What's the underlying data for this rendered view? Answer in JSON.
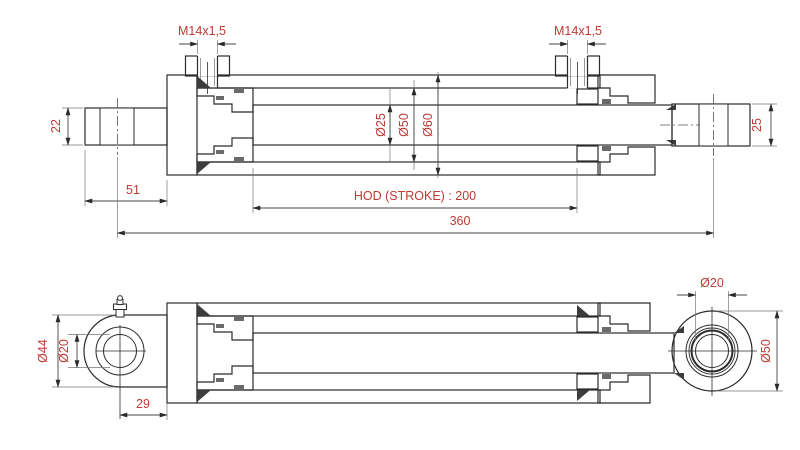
{
  "colors": {
    "dimension_text": "#bf3a35",
    "line": "#2b2b2b",
    "background": "#ffffff"
  },
  "side_section_view": {
    "left_port_thread": "M14x1,5",
    "right_port_thread": "M14x1,5",
    "rod_diameter": "Ø25",
    "bore_diameter": "Ø50",
    "tube_outer_diameter": "Ø60",
    "left_eye_width": "22",
    "right_eye_width": "25",
    "left_eye_to_tube": "51",
    "stroke_label": "HOD (STROKE) : 200",
    "overall_length": "360"
  },
  "plan_view": {
    "left_eye_outer_diameter": "Ø44",
    "left_eye_pin_diameter": "Ø20",
    "left_eye_center_to_tube": "29",
    "right_eye_pin_diameter": "Ø20",
    "right_eye_outer_diameter": "Ø50"
  }
}
